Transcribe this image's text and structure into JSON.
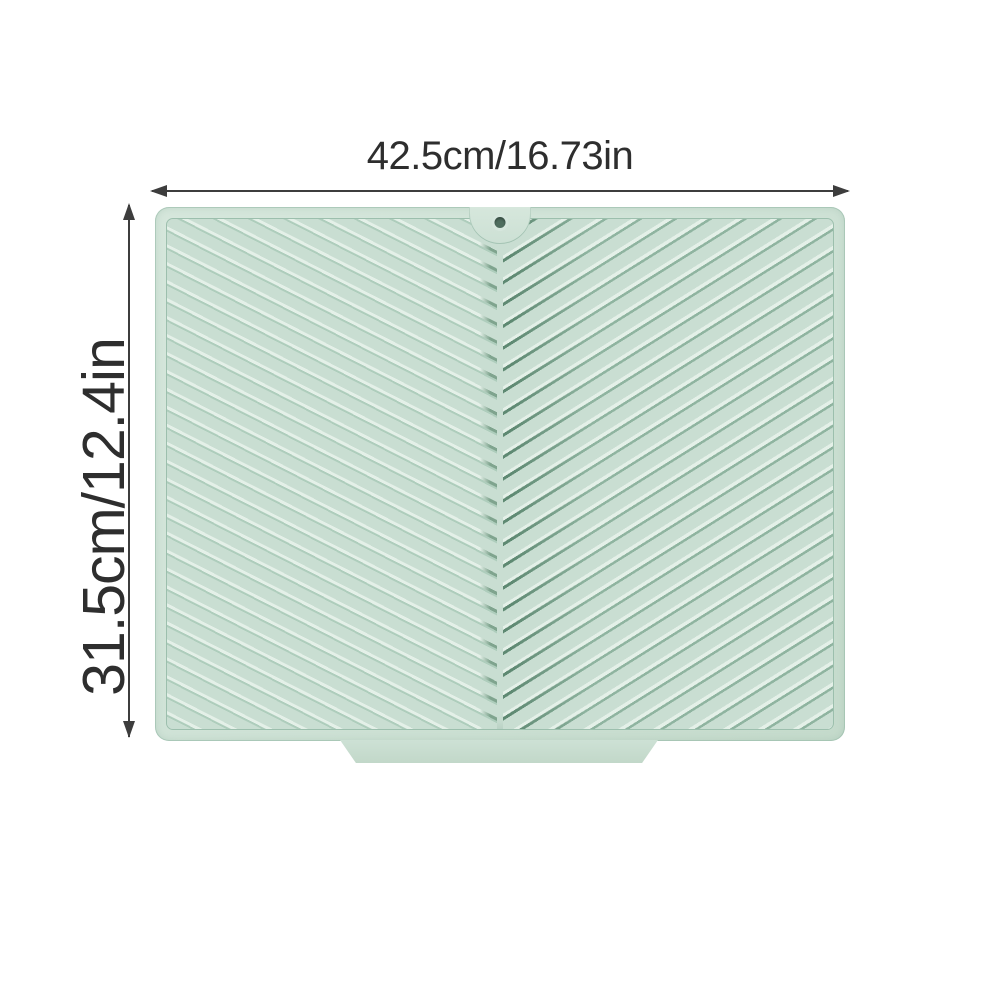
{
  "dimensions": {
    "width": {
      "label": "42.5cm/16.73in"
    },
    "height": {
      "label": "31.5cm/12.4in"
    }
  },
  "colors": {
    "background": "#ffffff",
    "text": "#2e2e2e",
    "dimension-line": "#3d3d3d",
    "mat-base": "#d0e3d7",
    "pattern-base": "#c9ded2",
    "ridge-highlight": "#e4f0e8",
    "ridge-shadow-left": "#aecdbc",
    "ridge-shadow-right": "#8fb4a0",
    "seam-shadow": "#5e8972",
    "tip-shadow": "#7fa48e",
    "rim-line": "#9cbfad",
    "hole": "#4f6e5f"
  }
}
